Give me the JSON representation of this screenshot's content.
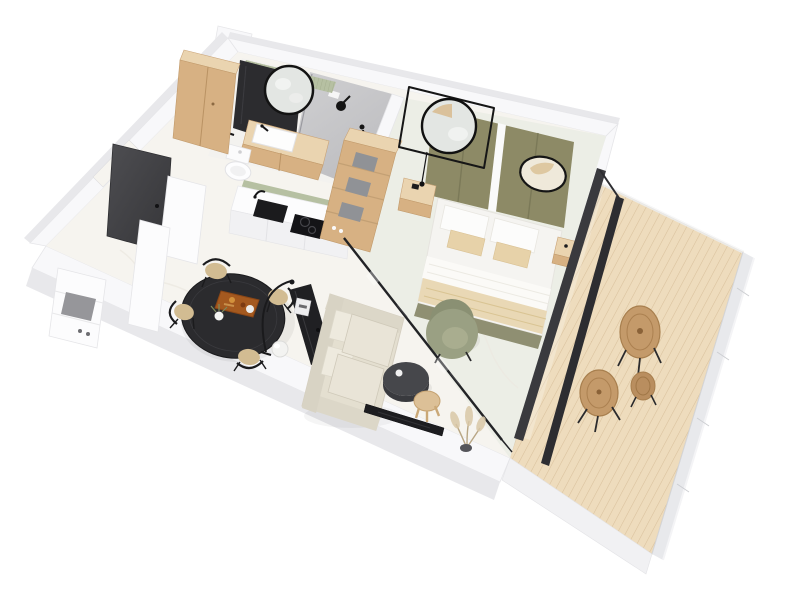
{
  "scene": {
    "type": "3d-floorplan-render",
    "description": "Axonometric 3D render of a studio apartment, white walls, viewed from above at an angle; bathroom top-left, kitchen and entry on the left, living-dining area in the centre, glass-partitioned bedroom on the right and a wooden terrace attached at the right side",
    "background": "#ffffff",
    "projection": "axonometric-top-down, plan rotated about -20 degrees"
  },
  "palette": {
    "background": "#ffffff",
    "wall_top": "#f8f8fa",
    "wall_edge": "#e6e6e9",
    "wall_face": "#e8e8eb",
    "floor": "#f6f4ef",
    "floor_bedroom": "#eaece4",
    "bath_floor": "#f3f2ef",
    "tile_gray": "#c7c7c9",
    "sage": "#b6c0a2",
    "wood": "#d7b183",
    "wood_light": "#ead4b0",
    "wood_dark": "#c19a6b",
    "deck_wood": "#eedcbd",
    "deck_line": "#d9c19c",
    "olive": "#8d8a66",
    "olive_chair": "#9aa083",
    "black": "#1e1e21",
    "dark_frame": "#3a3a3e",
    "door_gray": "#47474b",
    "sofa": "#e4dfd0",
    "beige": "#e7d2a9",
    "rattan": "#c49a6a",
    "mirror": "#e3e6e3",
    "storage_gray": "#909296",
    "glass_rail": "#e6e7ea"
  },
  "rooms": [
    {
      "name": "entry",
      "items": [
        "dark-entry-door",
        "hall-partition-walls",
        "white-shoe-shelf",
        "gray-door-mat"
      ]
    },
    {
      "name": "bathroom",
      "items": [
        "walk-in-shower",
        "gray-tile-wall",
        "rain-shower-head",
        "hand-shower",
        "round-black-framed-mirror",
        "dark-wall-panel",
        "sage-slat-wall",
        "wood-vanity",
        "white-washbasin",
        "black-faucet",
        "toilet",
        "black-towel-rail",
        "tall-wood-cabinet"
      ]
    },
    {
      "name": "kitchen",
      "items": [
        "white-base-cabinets",
        "white-countertop",
        "black-sink",
        "black-faucet",
        "black-induction-hob",
        "sage-backsplash"
      ]
    },
    {
      "name": "closet",
      "items": [
        "open-wood-shelf-unit",
        "gray-storage-boxes",
        "shoes"
      ]
    },
    {
      "name": "living_dining",
      "items": [
        "round-black-dining-table",
        "black-dining-chairs",
        "serving-tray-with-food",
        "flower-vase",
        "cream-sofa",
        "black-console-table",
        "coffee-machine",
        "white-sphere-floor-lamp",
        "black-arc-floor-lamp",
        "round-dark-coffee-table",
        "round-wood-side-table",
        "wall-mounted-tv",
        "pampas-plant"
      ]
    },
    {
      "name": "bedroom",
      "items": [
        "double-bed",
        "white-bedding",
        "beige-throw",
        "olive-headboard-panels",
        "square-framed-round-mirror",
        "oval-wall-mirror",
        "wood-nightstands",
        "black-pendant-light",
        "olive-armchair",
        "glass-partition",
        "dark-sliding-glass-doors"
      ]
    },
    {
      "name": "terrace",
      "items": [
        "wood-plank-deck",
        "glass-balustrade",
        "rattan-round-chairs",
        "rattan-round-table",
        "rattan-side-table"
      ]
    }
  ],
  "counts": {
    "dining_chairs": 4,
    "rattan_deck_pieces": 3,
    "bed_pillows": 4,
    "storage_boxes": 3,
    "olive_headboard_panels": 3
  }
}
